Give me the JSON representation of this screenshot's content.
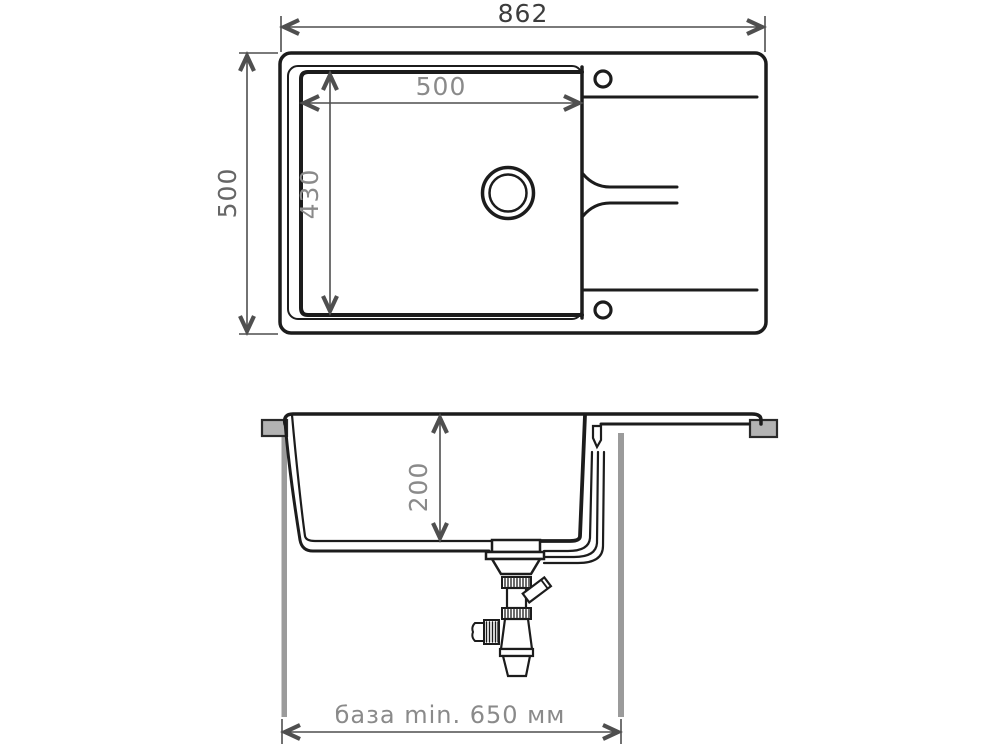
{
  "diagram": {
    "title": "kitchen-sink-installation-drawing",
    "views": {
      "top": {
        "name": "top view",
        "labels": {
          "overall_width": "862",
          "overall_depth": "500",
          "bowl_width": "500",
          "bowl_depth": "430"
        }
      },
      "section": {
        "name": "front section view",
        "labels": {
          "bowl_height": "200",
          "cabinet_base": "база min. 650 мм"
        }
      }
    },
    "colors": {
      "line": "#1c1c1c",
      "dimension": "#4f4f4f",
      "label_dark": "#3d3d3d",
      "label_mid": "#666666",
      "label_light": "#8a8a8a",
      "panel_gray": "#9b9b9b",
      "bracket_gray": "#b3b3b3",
      "background": "#ffffff"
    }
  }
}
